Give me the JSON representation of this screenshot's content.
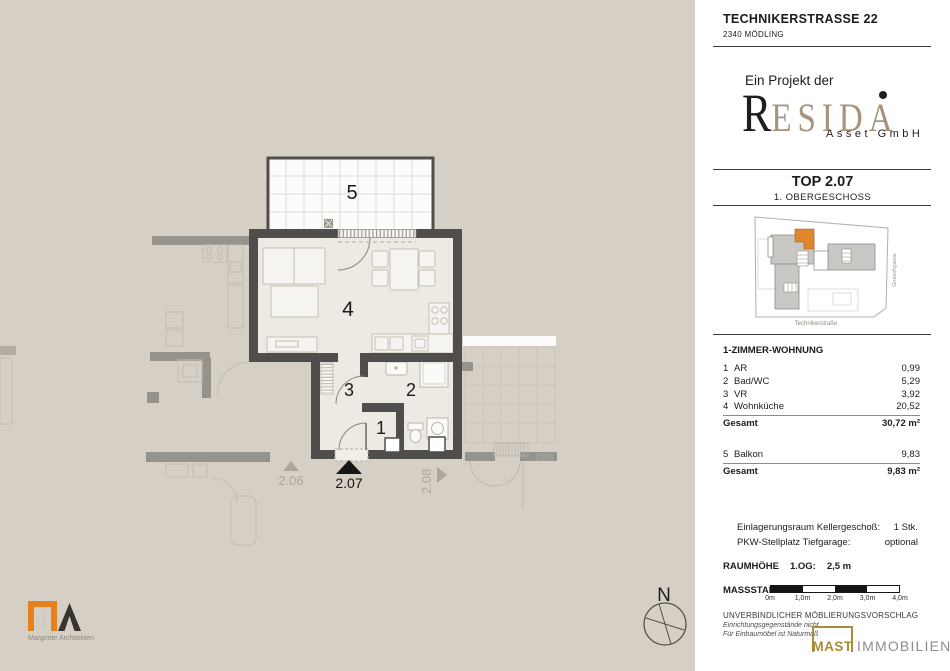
{
  "header": {
    "street": "TECHNIKERSTRASSE 22",
    "city": "2340 MÖDLING"
  },
  "project": {
    "prefix": "Ein Projekt der",
    "brand_initial": "R",
    "brand_rest": "ESIDA",
    "brand_sub": "Asset GmbH"
  },
  "unit": {
    "name": "TOP 2.07",
    "floor": "1. OBERGESCHOSS"
  },
  "site_map": {
    "street_side": "Grutschgasse",
    "street_bottom": "Technikerstraße"
  },
  "area_table": {
    "heading": "1-ZIMMER-WOHNUNG",
    "rows": [
      {
        "nr": "1",
        "name": "AR",
        "area": "0,99"
      },
      {
        "nr": "2",
        "name": "Bad/WC",
        "area": "5,29"
      },
      {
        "nr": "3",
        "name": "VR",
        "area": "3,92"
      },
      {
        "nr": "4",
        "name": "Wohnküche",
        "area": "20,52"
      }
    ],
    "total_label": "Gesamt",
    "total_value": "30,72 m²",
    "balcony": {
      "nr": "5",
      "name": "Balkon",
      "area": "9,83"
    },
    "balcony_total_label": "Gesamt",
    "balcony_total_value": "9,83 m²"
  },
  "extras": {
    "rows": [
      {
        "label": "Einlagerungsraum Kellergeschoß:",
        "value": "1 Stk."
      },
      {
        "label": "PKW-Stellplatz Tiefgarage:",
        "value": "optional"
      }
    ]
  },
  "room_height": {
    "label": "RAUMHÖHE",
    "floor": "1.OG:",
    "value": "2,5 m"
  },
  "scale": {
    "label": "MASSSTAB",
    "ticks": [
      "0m",
      "1,0m",
      "2,0m",
      "3,0m",
      "4,0m"
    ]
  },
  "disclaimer": {
    "line1": "UNVERBINDLICHER MÖBLIERUNGSVORSCHLAG",
    "line2": "Einrichtungsgegenstände nicht",
    "line3": "Für Einbaumöbel ist Naturmaß"
  },
  "broker": {
    "name": "MAST",
    "suffix": "IMMOBILIEN"
  },
  "architect": {
    "word1": "Marginter",
    "word2": "Architekten"
  },
  "plan": {
    "rooms": {
      "r1": "1",
      "r2": "2",
      "r3": "3",
      "r4": "4",
      "r5": "5"
    },
    "units": {
      "left": "2.06",
      "current": "2.07",
      "right": "2.08"
    },
    "compass_n": "N"
  },
  "colors": {
    "paper_beige": "#d6cfc5",
    "wall_dark": "#4f4e4c",
    "wall_light": "#96938c",
    "highlight_orange": "#e0862c",
    "brand_tan": "#a5947c",
    "broker_gold": "#aa8c34",
    "architect_orange": "#e8811c"
  }
}
